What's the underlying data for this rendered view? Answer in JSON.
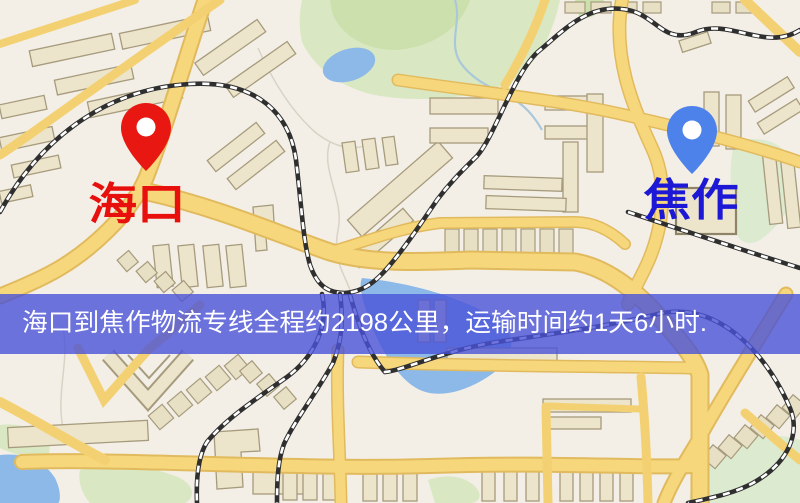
{
  "map": {
    "origin_marker": {
      "label": "海口",
      "pin_color": "#e81712",
      "label_color": "#e8100c"
    },
    "destination_marker": {
      "label": "焦作",
      "pin_color": "#4d82ea",
      "label_color": "#1c18d6"
    },
    "banner": {
      "text": "海口到焦作物流专线全程约2198公里，运输时间约1天6小时.",
      "bg_color": "#4a52d8",
      "text_color": "#ffffff"
    },
    "palette": {
      "background": "#f3efe6",
      "road": "#f6d77c",
      "road_edge": "#e2ba5e",
      "building": "#ece4cb",
      "water": "#8cb9e8",
      "park": "#d9e8c2",
      "railway": "#2f2f2f"
    }
  }
}
